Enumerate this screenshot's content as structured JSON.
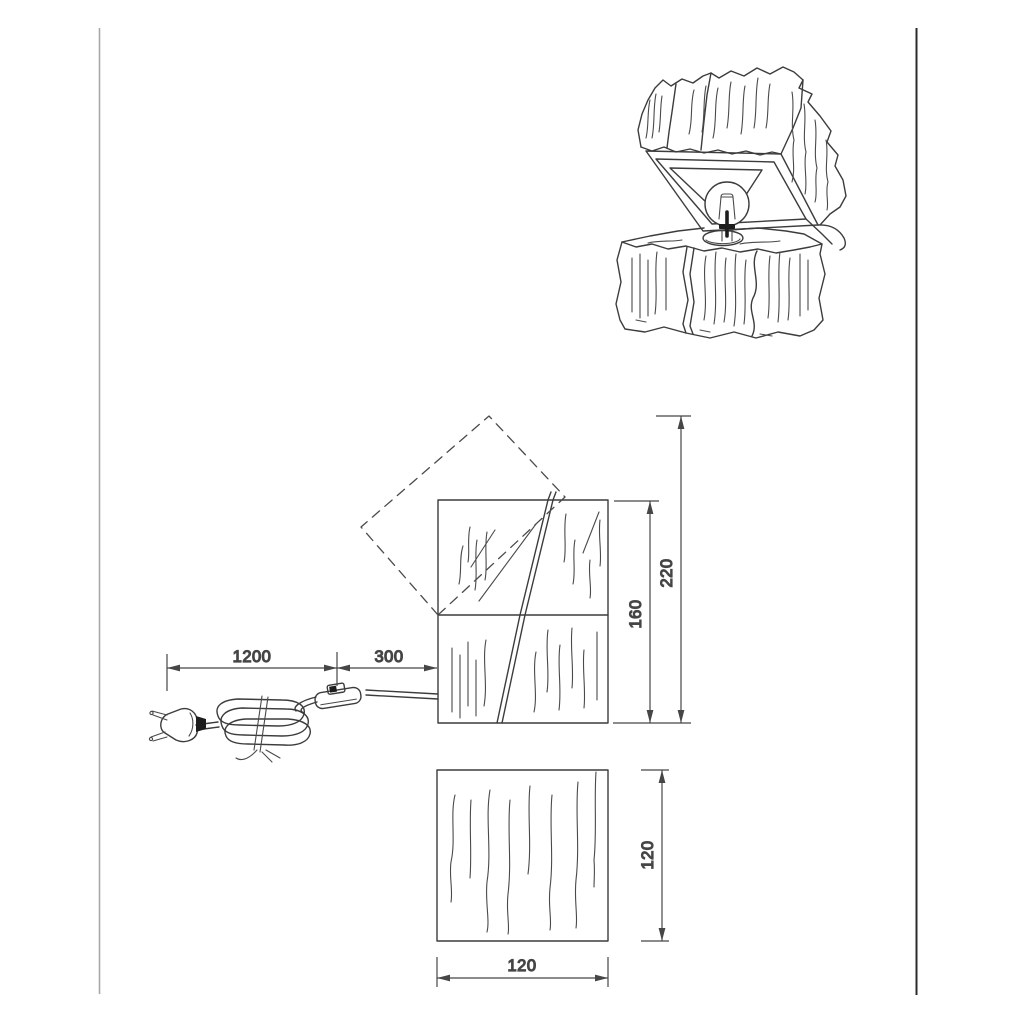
{
  "drawing": {
    "type": "product-technical-drawing",
    "subject": "wooden log table lamp with hinged lid and bulb",
    "views": [
      "perspective-sketch",
      "front-view-with-cable",
      "bottom-view"
    ]
  },
  "colors": {
    "background": "#ffffff",
    "line": "#3c3c3c",
    "dimension_line": "#464646",
    "text": "#3f3f3f",
    "page_border_left": "#a8a8a8",
    "page_border_right": "#2b2b2b"
  },
  "dimensions": {
    "cable_plug_to_switch": "1200",
    "cable_switch_to_lamp": "300",
    "overall_height": "220",
    "body_height": "160",
    "body_side_height": "120",
    "body_width": "120"
  }
}
